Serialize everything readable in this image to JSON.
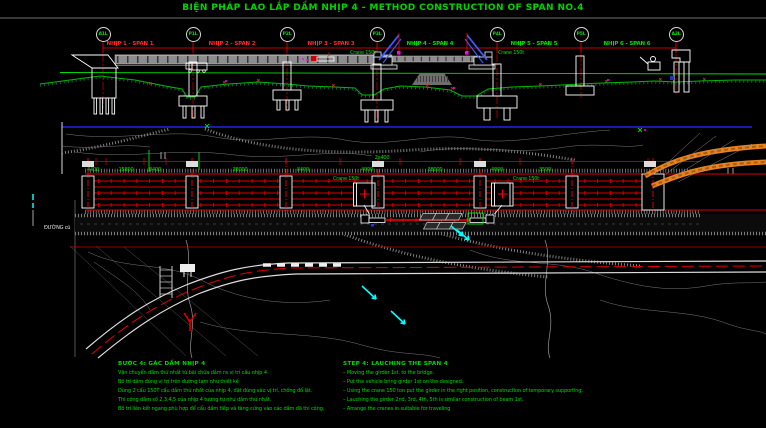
{
  "title": "BIỆN PHÁP LAO LẮP DẦM NHỊP 4 - METHOD CONSTRUCTION OF SPAN NO.4",
  "colors": {
    "background": "#000000",
    "title_green": "#00d400",
    "dimension_red": "#ff2222",
    "ground_green": "#00cc00",
    "crane_boom_blue": "#3a5cff",
    "contour_gray": "#808080",
    "ramp_orange": "#e8821e",
    "water_cyan": "#00ffff",
    "marker_magenta": "#ff00ff",
    "north_line_blue": "#2222ee"
  },
  "labels": {
    "crane": "Crane 150t",
    "old_road": "ĐƯỜNG cũ"
  },
  "elevation": {
    "piers": [
      {
        "label": "A1L"
      },
      {
        "label": "P1L"
      },
      {
        "label": "P2L"
      },
      {
        "label": "P3L"
      },
      {
        "label": "P4L"
      },
      {
        "label": "P5L"
      },
      {
        "label": "A2L"
      }
    ],
    "spans": [
      {
        "label": "NHỊP 1 - SPAN 1"
      },
      {
        "label": "NHỊP 2 - SPAN 2"
      },
      {
        "label": "NHỊP 3 - SPAN 3"
      },
      {
        "label": "NHỊP 4 - SPAN 4"
      },
      {
        "label": "NHỊP 5 - SPAN 5"
      },
      {
        "label": "NHỊP 6 - SPAN 6"
      }
    ]
  },
  "plan": {
    "dims": [
      "4400",
      "15800",
      "8400",
      "38000",
      "8400",
      "4000",
      "2x400",
      "38000",
      "4000",
      "3500"
    ]
  },
  "notes_vi": {
    "title": "BƯỚC 4: GÁC DẦM NHỊP 4",
    "items": [
      "Vận chuyển dầm thứ nhất từ bãi chứa dầm ra vị trí cầu nhịp 4",
      "Bố trí dầm đúng vị trí trên đường tạm như thiết kế",
      "Dùng 2 cẩu 150T cẩu dầm thứ nhất của nhịp 4, đặt đúng vào vị trí, chống đổ lật.",
      "Thi công dầm số 2,3,4,5 của nhịp 4 tương tự như dầm thứ nhất.",
      "Bố trí liên kết ngang phù hợp để cẩu dầm tiếp và tăng cứng vào các dầm đã thi công."
    ]
  },
  "notes_en": {
    "title": "STEP 4: LAUCHING THE SPAN 4",
    "items": [
      "– Moving the girder 1st. to the bridge.",
      "– Put the vehicle bring girder 1st on the designed.",
      "– Using the crane 150 ton put the girder in the right position, construction of temporary supporting.",
      "– Lauching the girder 2nd, 3rd, 4th, 5th is similar construction of beam 1st.",
      "– Arrange the cranes in suitable for traveling"
    ]
  }
}
